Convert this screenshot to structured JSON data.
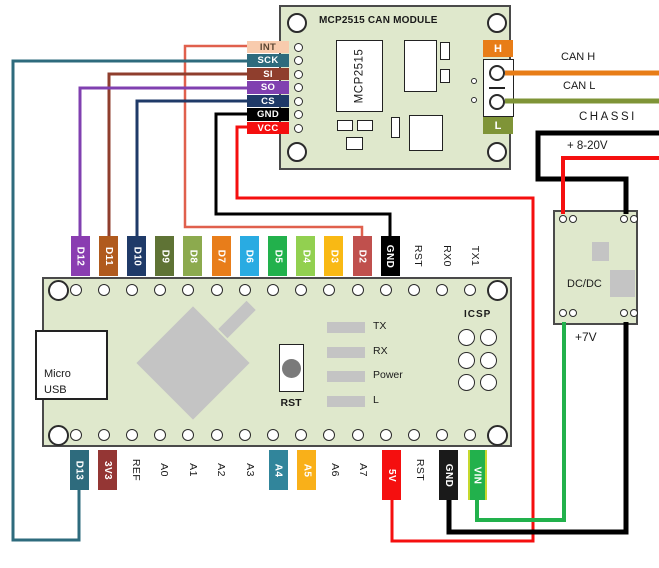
{
  "colors": {
    "board_green": "#dfe8cc",
    "board_border": "#4a4a4a",
    "component_gray": "#c4c4c4",
    "terminal_h_orange": "#e87d17",
    "terminal_l_olive": "#7f9437"
  },
  "mcp2515": {
    "title": "MCP2515 CAN MODULE",
    "chip_label": "MCP2515",
    "terminal_h": "H",
    "terminal_l": "L",
    "left_pins": [
      {
        "label": "INT",
        "bg": "#f8cbad",
        "text": "#5b4632"
      },
      {
        "label": "SCK",
        "bg": "#2e6b7d"
      },
      {
        "label": "SI",
        "bg": "#8f3e2d"
      },
      {
        "label": "SO",
        "bg": "#8040b0"
      },
      {
        "label": "CS",
        "bg": "#1f3a68"
      },
      {
        "label": "GND",
        "bg": "#000000"
      },
      {
        "label": "VCC",
        "bg": "#f50f0f"
      }
    ]
  },
  "right_labels": {
    "can_h": "CAN H",
    "can_l": "CAN L",
    "chassis": "CHASSI",
    "supply": "+ 8-20V",
    "v7": "+7V"
  },
  "dcdc": {
    "label": "DC/DC"
  },
  "arduino": {
    "usb_line1": "Micro",
    "usb_line2": "USB",
    "reset_label": "RST",
    "icsp_label": "ICSP",
    "leds": [
      {
        "label": "TX"
      },
      {
        "label": "RX"
      },
      {
        "label": "Power"
      },
      {
        "label": "L"
      }
    ],
    "top_pins": [
      {
        "label": "D12",
        "bg": "#8a3db1"
      },
      {
        "label": "D11",
        "bg": "#b05a1d"
      },
      {
        "label": "D10",
        "bg": "#1f3a68"
      },
      {
        "label": "D9",
        "bg": "#5f7335"
      },
      {
        "label": "D8",
        "bg": "#8caa4e"
      },
      {
        "label": "D7",
        "bg": "#e87d1a"
      },
      {
        "label": "D6",
        "bg": "#29abe2"
      },
      {
        "label": "D5",
        "bg": "#22b14c"
      },
      {
        "label": "D4",
        "bg": "#92d050"
      },
      {
        "label": "D3",
        "bg": "#f9b914"
      },
      {
        "label": "D2",
        "bg": "#c0504d"
      },
      {
        "label": "GND",
        "bg": "#000000"
      },
      {
        "label": "RST",
        "bg": null
      },
      {
        "label": "RX0",
        "bg": null
      },
      {
        "label": "TX1",
        "bg": null
      }
    ],
    "bottom_pins": [
      {
        "label": "D13",
        "bg": "#2e6b7d"
      },
      {
        "label": "3V3",
        "bg": "#943634"
      },
      {
        "label": "REF",
        "bg": null
      },
      {
        "label": "A0",
        "bg": null
      },
      {
        "label": "A1",
        "bg": null
      },
      {
        "label": "A2",
        "bg": null
      },
      {
        "label": "A3",
        "bg": null
      },
      {
        "label": "A4",
        "bg": "#31859b"
      },
      {
        "label": "A5",
        "bg": "#f9b019"
      },
      {
        "label": "A6",
        "bg": null
      },
      {
        "label": "A7",
        "bg": null
      },
      {
        "label": "5V",
        "bg": "#f50f0f"
      },
      {
        "label": "RST",
        "bg": null
      },
      {
        "label": "GND",
        "bg": "#1a1a1a"
      },
      {
        "label": "VIN",
        "bg": "#22b14c",
        "edge": "#c6d92e"
      }
    ]
  },
  "wires": [
    {
      "name": "int-to-d2",
      "from": "MCP2515 INT",
      "to": "Nano D2",
      "color": "#e0604d",
      "width": 2.5,
      "points": [
        [
          248,
          46
        ],
        [
          185,
          46
        ],
        [
          185,
          227
        ],
        [
          362,
          227
        ],
        [
          362,
          238
        ]
      ]
    },
    {
      "name": "sck-to-d13",
      "from": "MCP2515 SCK",
      "to": "Nano D13",
      "color": "#2e6b7d",
      "width": 3,
      "points": [
        [
          248,
          61
        ],
        [
          13,
          61
        ],
        [
          13,
          540
        ],
        [
          79,
          540
        ],
        [
          79,
          489
        ]
      ]
    },
    {
      "name": "si-to-d11",
      "from": "MCP2515 SI",
      "to": "Nano D11",
      "color": "#8f3e2d",
      "width": 3,
      "points": [
        [
          248,
          74
        ],
        [
          109,
          74
        ],
        [
          109,
          238
        ]
      ]
    },
    {
      "name": "so-to-d12",
      "from": "MCP2515 SO",
      "to": "Nano D12",
      "color": "#8040b0",
      "width": 3,
      "points": [
        [
          248,
          88
        ],
        [
          80,
          88
        ],
        [
          80,
          238
        ]
      ]
    },
    {
      "name": "cs-to-d10",
      "from": "MCP2515 CS",
      "to": "Nano D10",
      "color": "#1f3a68",
      "width": 3,
      "points": [
        [
          248,
          101
        ],
        [
          137,
          101
        ],
        [
          137,
          238
        ]
      ]
    },
    {
      "name": "gnd-to-gnd-top",
      "from": "MCP2515 GND",
      "to": "Nano GND (top)",
      "color": "#000000",
      "width": 3,
      "points": [
        [
          248,
          114
        ],
        [
          216,
          114
        ],
        [
          216,
          214
        ],
        [
          390,
          214
        ],
        [
          390,
          238
        ]
      ]
    },
    {
      "name": "vcc-to-5v",
      "from": "MCP2515 VCC",
      "to": "Nano 5V",
      "color": "#f50f0f",
      "width": 3,
      "points": [
        [
          248,
          127
        ],
        [
          237,
          127
        ],
        [
          237,
          198
        ],
        [
          533,
          198
        ],
        [
          533,
          541
        ],
        [
          392,
          541
        ],
        [
          392,
          499
        ]
      ]
    },
    {
      "name": "can-h",
      "from": "MCP2515 H",
      "to": "CAN H",
      "color": "#e87d17",
      "width": 5,
      "points": [
        [
          505,
          73
        ],
        [
          659,
          73
        ]
      ]
    },
    {
      "name": "can-l",
      "from": "MCP2515 L",
      "to": "CAN L",
      "color": "#7f9437",
      "width": 5,
      "points": [
        [
          505,
          101
        ],
        [
          659,
          101
        ]
      ]
    },
    {
      "name": "chassis-to-dcdc",
      "from": "CHASSI",
      "to": "DC/DC input -",
      "color": "#000000",
      "width": 5,
      "points": [
        [
          659,
          133
        ],
        [
          538,
          133
        ],
        [
          538,
          179
        ],
        [
          626,
          179
        ],
        [
          626,
          214
        ]
      ]
    },
    {
      "name": "supply-to-dcdc",
      "from": "+ 8-20V",
      "to": "DC/DC input +",
      "color": "#f50f0f",
      "width": 4,
      "points": [
        [
          659,
          158
        ],
        [
          563,
          158
        ],
        [
          563,
          214
        ]
      ]
    },
    {
      "name": "dcdc-7v-to-vin",
      "from": "DC/DC +7V",
      "to": "Nano VIN",
      "color": "#22b14c",
      "width": 4,
      "points": [
        [
          564,
          322
        ],
        [
          564,
          520
        ],
        [
          477,
          520
        ],
        [
          477,
          499
        ]
      ]
    },
    {
      "name": "dcdc-gnd-to-gnd",
      "from": "DC/DC GND",
      "to": "Nano GND (bottom)",
      "color": "#000000",
      "width": 5,
      "points": [
        [
          626,
          322
        ],
        [
          626,
          532
        ],
        [
          449,
          532
        ],
        [
          449,
          499
        ]
      ]
    }
  ]
}
